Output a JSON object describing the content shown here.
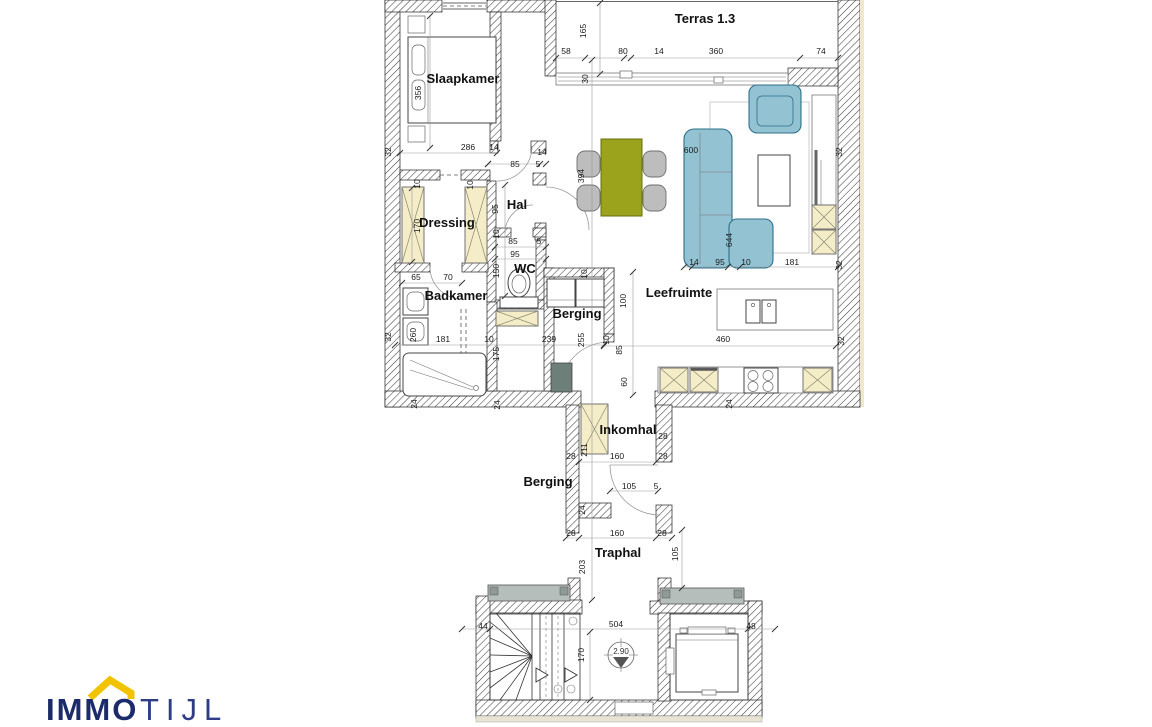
{
  "logo": {
    "immo": "IMMO",
    "tijl": "TIJL"
  },
  "level_marker": {
    "value": "2.90"
  },
  "colors": {
    "cream_cabinet": "#f4edc8",
    "sofa_blue": "#93c2d2",
    "table_olive": "#9aa31b",
    "chair_gray": "#bdbdbd",
    "slab_gray": "#b6bebb",
    "logo_navy": "#1c2b6b",
    "logo_tijl_navy": "#2e3d85",
    "roof_yellow": "#f2c300"
  },
  "rooms": [
    {
      "id": "slaapkamer",
      "label": "Slaapkamer",
      "x": 463,
      "y": 83
    },
    {
      "id": "terras",
      "label": "Terras 1.3",
      "x": 705,
      "y": 23
    },
    {
      "id": "dressing",
      "label": "Dressing",
      "x": 447,
      "y": 227
    },
    {
      "id": "hal",
      "label": "Hal",
      "x": 517,
      "y": 209
    },
    {
      "id": "wc",
      "label": "WC",
      "x": 525,
      "y": 273
    },
    {
      "id": "badkamer",
      "label": "Badkamer",
      "x": 456,
      "y": 300
    },
    {
      "id": "berging-1",
      "label": "Berging",
      "x": 577,
      "y": 318
    },
    {
      "id": "leefruimte",
      "label": "Leefruimte",
      "x": 679,
      "y": 297
    },
    {
      "id": "inkomhal",
      "label": "Inkomhal",
      "x": 628,
      "y": 434
    },
    {
      "id": "berging-2",
      "label": "Berging",
      "x": 548,
      "y": 486
    },
    {
      "id": "traphal",
      "label": "Traphal",
      "x": 618,
      "y": 557
    }
  ],
  "dims": [
    {
      "t": "165",
      "x": 586,
      "y": 31,
      "r": 1
    },
    {
      "t": "58",
      "x": 566,
      "y": 54
    },
    {
      "t": "80",
      "x": 623,
      "y": 54
    },
    {
      "t": "14",
      "x": 659,
      "y": 54
    },
    {
      "t": "360",
      "x": 716,
      "y": 54
    },
    {
      "t": "74",
      "x": 821,
      "y": 54
    },
    {
      "t": "30",
      "x": 588,
      "y": 79,
      "r": 1
    },
    {
      "t": "356",
      "x": 421,
      "y": 93,
      "r": 1
    },
    {
      "t": "32",
      "x": 391,
      "y": 152,
      "r": 1
    },
    {
      "t": "286",
      "x": 468,
      "y": 150
    },
    {
      "t": "14",
      "x": 494,
      "y": 150
    },
    {
      "t": "14",
      "x": 542,
      "y": 155
    },
    {
      "t": "85",
      "x": 515,
      "y": 167
    },
    {
      "t": "5",
      "x": 538,
      "y": 167
    },
    {
      "t": "10",
      "x": 420,
      "y": 184,
      "r": 1
    },
    {
      "t": "10",
      "x": 473,
      "y": 185,
      "r": 1
    },
    {
      "t": "170",
      "x": 420,
      "y": 226,
      "r": 1
    },
    {
      "t": "95",
      "x": 498,
      "y": 209,
      "r": 1
    },
    {
      "t": "10",
      "x": 499,
      "y": 234,
      "r": 1
    },
    {
      "t": "85",
      "x": 513,
      "y": 244
    },
    {
      "t": "5",
      "x": 539,
      "y": 244
    },
    {
      "t": "95",
      "x": 515,
      "y": 257
    },
    {
      "t": "150",
      "x": 499,
      "y": 271,
      "r": 1
    },
    {
      "t": "65",
      "x": 416,
      "y": 280
    },
    {
      "t": "70",
      "x": 448,
      "y": 280
    },
    {
      "t": "260",
      "x": 416,
      "y": 335,
      "r": 1
    },
    {
      "t": "32",
      "x": 391,
      "y": 337,
      "r": 1
    },
    {
      "t": "181",
      "x": 443,
      "y": 342
    },
    {
      "t": "10",
      "x": 489,
      "y": 342
    },
    {
      "t": "239",
      "x": 549,
      "y": 342
    },
    {
      "t": "255",
      "x": 584,
      "y": 340,
      "r": 1
    },
    {
      "t": "175",
      "x": 499,
      "y": 354,
      "r": 1
    },
    {
      "t": "24",
      "x": 417,
      "y": 404,
      "r": 1
    },
    {
      "t": "24",
      "x": 500,
      "y": 405,
      "r": 1
    },
    {
      "t": "10",
      "x": 587,
      "y": 274,
      "r": 1
    },
    {
      "t": "100",
      "x": 626,
      "y": 301,
      "r": 1
    },
    {
      "t": "10",
      "x": 609,
      "y": 340,
      "r": 1
    },
    {
      "t": "85",
      "x": 622,
      "y": 350,
      "r": 1
    },
    {
      "t": "60",
      "x": 627,
      "y": 382,
      "r": 1
    },
    {
      "t": "394",
      "x": 584,
      "y": 176,
      "r": 1
    },
    {
      "t": "600",
      "x": 691,
      "y": 153
    },
    {
      "t": "644",
      "x": 732,
      "y": 240,
      "r": 1
    },
    {
      "t": "14",
      "x": 694,
      "y": 265
    },
    {
      "t": "95",
      "x": 720,
      "y": 265
    },
    {
      "t": "10",
      "x": 746,
      "y": 265
    },
    {
      "t": "181",
      "x": 792,
      "y": 265
    },
    {
      "t": "32",
      "x": 842,
      "y": 152,
      "r": 1
    },
    {
      "t": "32",
      "x": 842,
      "y": 265,
      "r": 1
    },
    {
      "t": "32",
      "x": 844,
      "y": 341,
      "r": 1
    },
    {
      "t": "460",
      "x": 723,
      "y": 342
    },
    {
      "t": "24",
      "x": 732,
      "y": 404,
      "r": 1
    },
    {
      "t": "211",
      "x": 587,
      "y": 450,
      "r": 1
    },
    {
      "t": "28",
      "x": 571,
      "y": 459
    },
    {
      "t": "160",
      "x": 617,
      "y": 459
    },
    {
      "t": "28",
      "x": 663,
      "y": 439
    },
    {
      "t": "28",
      "x": 663,
      "y": 459
    },
    {
      "t": "105",
      "x": 629,
      "y": 489
    },
    {
      "t": "5",
      "x": 656,
      "y": 489
    },
    {
      "t": "24",
      "x": 585,
      "y": 510,
      "r": 1
    },
    {
      "t": "28",
      "x": 571,
      "y": 536
    },
    {
      "t": "160",
      "x": 617,
      "y": 536
    },
    {
      "t": "28",
      "x": 662,
      "y": 536
    },
    {
      "t": "203",
      "x": 585,
      "y": 567,
      "r": 1
    },
    {
      "t": "105",
      "x": 678,
      "y": 554,
      "r": 1
    },
    {
      "t": "44",
      "x": 483,
      "y": 629
    },
    {
      "t": "504",
      "x": 616,
      "y": 627
    },
    {
      "t": "48",
      "x": 751,
      "y": 629
    },
    {
      "t": "170",
      "x": 584,
      "y": 655,
      "r": 1
    }
  ]
}
